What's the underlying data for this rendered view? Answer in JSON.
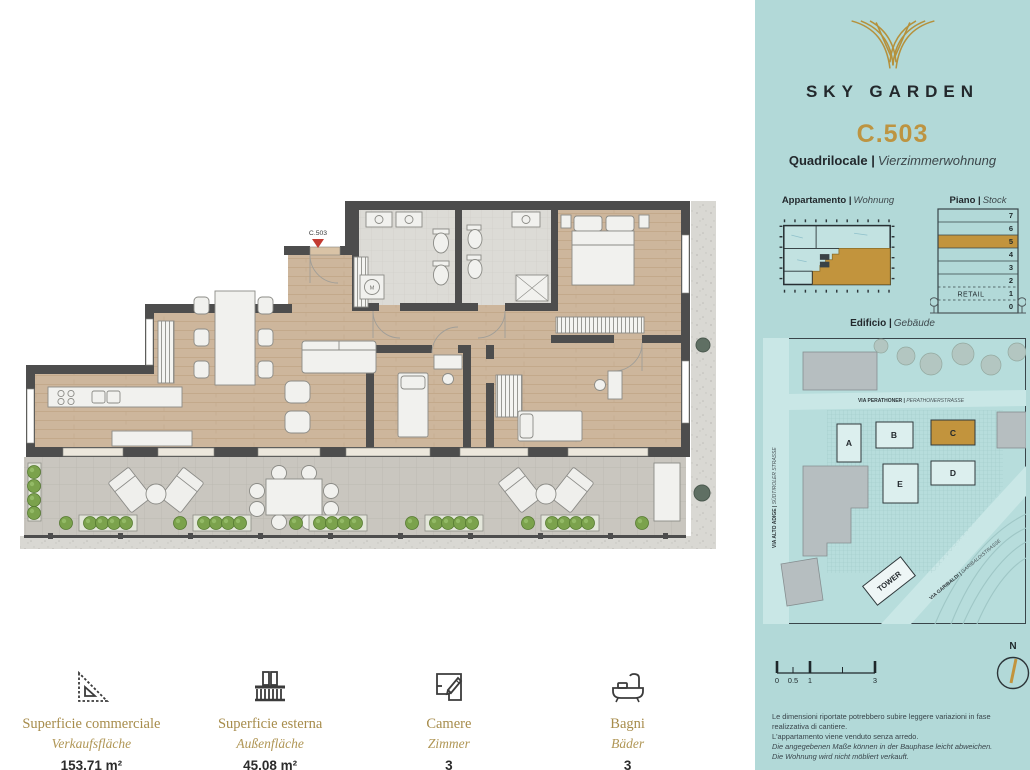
{
  "sidebar": {
    "brand": "SKY GARDEN",
    "unit_code": "C.503",
    "unit_type": {
      "it": "Quadrilocale |",
      "de": "Vierzimmerwohnung"
    },
    "labels": {
      "apartment_it": "Appartamento |",
      "apartment_de": "Wohnung",
      "floor_it": "Piano |",
      "floor_de": "Stock",
      "building_it": "Edificio |",
      "building_de": "Gebäude"
    },
    "stack": {
      "floors": [
        "7",
        "6",
        "5",
        "4",
        "3",
        "2",
        "1",
        "0"
      ],
      "highlighted_floor": "5",
      "retail": "RETAIL"
    },
    "map": {
      "streets": {
        "perathoner_it": "VIA PERATHONER | ",
        "perathoner_de": "PERATHONERSTRASSE",
        "altoadige_it": "VIA ALTO ADIGE | ",
        "altoadige_de": "SÜDTIROLER STRASSE",
        "garibaldi_it": "VIA GARIBALDI | ",
        "garibaldi_de": "GARIBALDISTRASSE"
      },
      "buildings": [
        "A",
        "B",
        "C",
        "D",
        "E"
      ],
      "highlighted_building": "C",
      "tower": "TOWER"
    },
    "scale_labels": [
      "0",
      "0.5",
      "1",
      "3"
    ],
    "north": "N",
    "disclaimer": [
      "Le dimensioni riportate potrebbero subire leggere variazioni in fase realizzativa di cantiere.",
      "L'appartamento viene venduto senza arredo.",
      "Die angegebenen Maße können in der Bauphase leicht abweichen.",
      "Die Wohnung wird nicht möbliert verkauft."
    ]
  },
  "plan": {
    "unit_marker": "C.503",
    "washer_label": "M"
  },
  "stats": [
    {
      "icon": "set-square-icon",
      "label_it": "Superficie commerciale",
      "label_de": "Verkaufsfläche",
      "value": "153.71 m²"
    },
    {
      "icon": "balcony-icon",
      "label_it": "Superficie esterna",
      "label_de": "Außenfläche",
      "value": "45.08 m²"
    },
    {
      "icon": "rooms-icon",
      "label_it": "Camere",
      "label_de": "Zimmer",
      "value": "3"
    },
    {
      "icon": "bathtub-icon",
      "label_it": "Bagni",
      "label_de": "Bäder",
      "value": "3"
    }
  ],
  "colors": {
    "teal": "#b2d9d8",
    "gold": "#bd9441",
    "wall": "#4d4d4d",
    "wood": "#cdb69c",
    "terrace": "#c9c6bf",
    "bath_tile": "#dcdbd6",
    "marker_red": "#c33a31",
    "dark_text": "#23282c"
  }
}
